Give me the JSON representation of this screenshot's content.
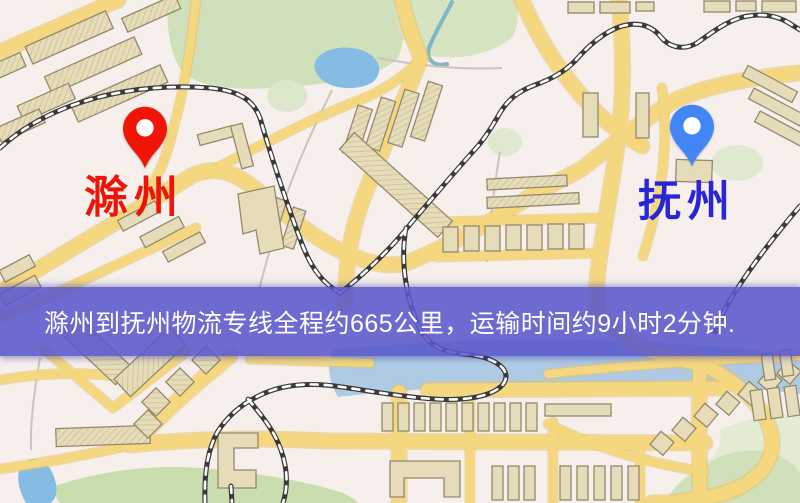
{
  "map": {
    "origin": {
      "label": "滁州",
      "pin_color": "#f01507",
      "label_color": "#ee1508"
    },
    "destination": {
      "label": "抚州",
      "pin_color": "#4285f4",
      "label_color": "#2a26d8"
    },
    "banner": {
      "text": "滁州到抚州物流专线全程约665公里，运输时间约9小时2分钟.",
      "background": "#5a58cc",
      "text_color": "#ffffff",
      "distance_text": "665公里",
      "duration_text": "9小时2分钟"
    }
  }
}
